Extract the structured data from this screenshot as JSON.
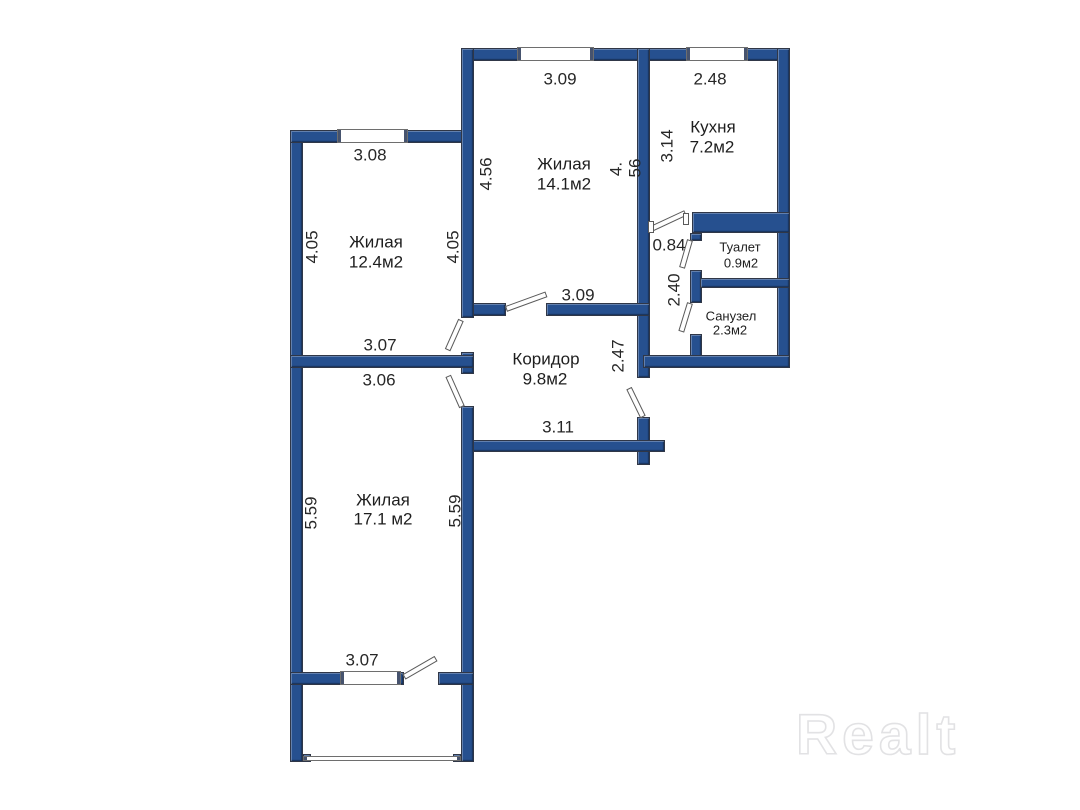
{
  "watermark": {
    "text": "Realt"
  },
  "colors": {
    "wall_fill": "#26508f",
    "background": "#ffffff",
    "dimension_text": "#272727"
  },
  "rooms": [
    {
      "key": "living-top",
      "name": "Жилая",
      "area": "14.1м2"
    },
    {
      "key": "kitchen",
      "name": "Кухня",
      "area": "7.2м2"
    },
    {
      "key": "toilet",
      "name": "Туалет",
      "area": "0.9м2"
    },
    {
      "key": "bathroom",
      "name": "Санузел",
      "area": "2.3м2"
    },
    {
      "key": "living-left",
      "name": "Жилая",
      "area": "12.4м2"
    },
    {
      "key": "corridor",
      "name": "Коридор",
      "area": "9.8м2"
    },
    {
      "key": "living-bottom",
      "name": "Жилая",
      "area": "17.1 м2"
    }
  ],
  "dimensions": {
    "top_room_width_top": "3.09",
    "kitchen_width": "2.48",
    "left_room_width_top": "3.08",
    "top_room_height_left": "4.56",
    "top_room_height_right_line1": "4.",
    "top_room_height_right_line2": "56",
    "kitchen_height": "3.14",
    "left_room_height_left": "4.05",
    "left_room_height_right": "4.05",
    "vestibule_width": "0.84",
    "vestibule_height": "2.40",
    "corridor_width_top": "3.09",
    "left_room_width_bottom": "3.07",
    "bottom_room_width_top": "3.06",
    "corridor_height": "2.47",
    "corridor_width_bottom": "3.11",
    "bottom_room_height_left": "5.59",
    "bottom_room_height_right": "5.59",
    "bottom_room_width_bottom": "3.07"
  }
}
